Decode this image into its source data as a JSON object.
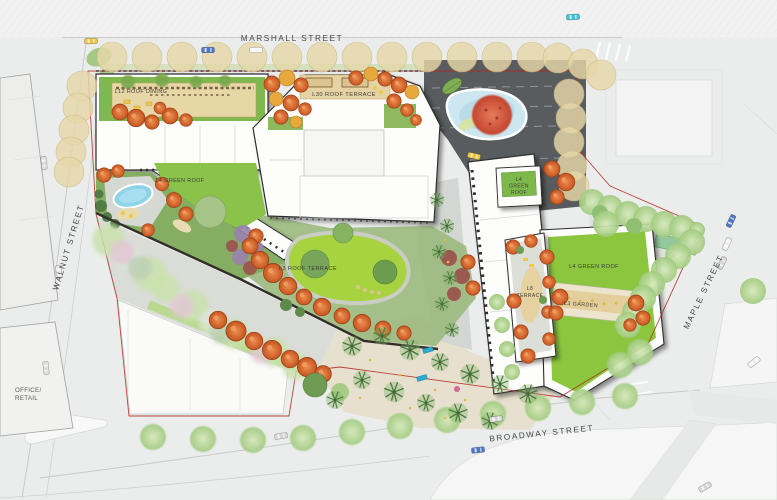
{
  "plan_title": "Landscape Site Plan",
  "streets": {
    "marshall": {
      "label": "MARSHALL STREET"
    },
    "walnut": {
      "label": "WALNUT STREET"
    },
    "maple": {
      "label": "MAPLE STREET"
    },
    "broadway": {
      "label": "BROADWAY STREET"
    }
  },
  "areas": {
    "l12_roof_dining": {
      "label": "L12 ROOF DINING"
    },
    "l30_roof_terrace": {
      "label": "L30 ROOF TERRACE"
    },
    "l4_green_roof_west": {
      "label": "L4 GREEN ROOF"
    },
    "l3_roof_terrace": {
      "label": "L3 ROOF TERRACE"
    },
    "l4_green_roof_small": {
      "lines": [
        "L4",
        "GREEN",
        "ROOF"
      ]
    },
    "l4_green_roof_east": {
      "label": "L4 GREEN ROOF"
    },
    "l8_terrace": {
      "lines": [
        "L8",
        "TERRACE"
      ]
    },
    "l3_garden": {
      "label": "L3 GARDEN"
    }
  },
  "adjacent_building": {
    "lines": [
      "OFFICE/",
      "RETAIL"
    ]
  },
  "colors": {
    "lawn_green": "#9bcf3e",
    "green_roof": "#86bc4a",
    "orange_tree": "#d2622e",
    "tan_tree": "#e4d6a7",
    "pond_blue": "#c7e3ee",
    "plaza_dark": "#595c5f",
    "property_line_red": "#b1271c",
    "paving_gray": "#d8dad6"
  }
}
